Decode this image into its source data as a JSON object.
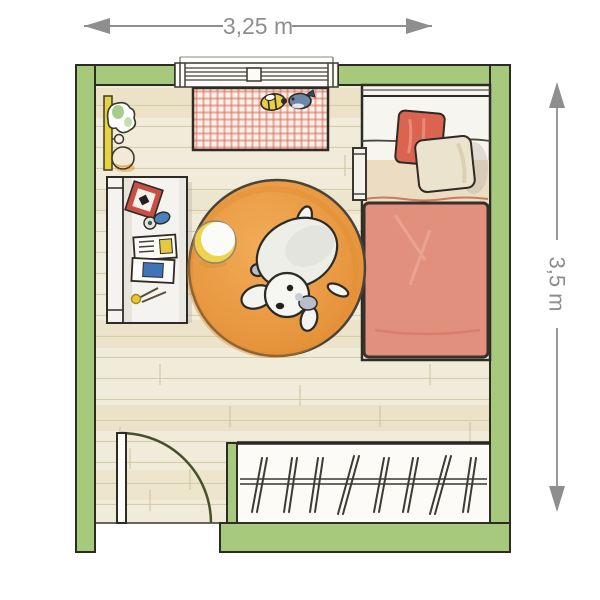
{
  "plan": {
    "type": "bedroom-floor-plan",
    "dimensions": {
      "width_label": "3,25 m",
      "height_label": "3,5 m"
    },
    "furniture": [
      "window",
      "wall-shelf-with-toys",
      "checkered-play-rug",
      "toy-bee",
      "toy-whale",
      "desk-with-frame-book-pencils",
      "bed",
      "red-pillow",
      "cream-pillow",
      "red-blanket",
      "bedside-rack",
      "round-orange-rug",
      "ball",
      "toy-dog",
      "closet-with-hangers",
      "door"
    ]
  },
  "colors": {
    "wall_green": "#a7c97e",
    "floor_base": "#f1ebd9",
    "floor_line": "#d6cdaa",
    "floor_streak": "#e2d2a9",
    "rug_orange": "#f2ab57",
    "rug_orange_deep": "#e28d34",
    "play_rug_base": "#faf1e9",
    "play_rug_red": "#d95f4d",
    "blanket_red": "#e2907e",
    "pillow_red": "#db6450",
    "pillow_cream": "#ebe3cd",
    "sheet_fold_tan": "#ecdcc2",
    "shelf_yellow": "#e9d23f",
    "ball_yellow": "#efd34a",
    "door_arc": "#46512c",
    "dimension_gray": "#8e8e8e"
  }
}
